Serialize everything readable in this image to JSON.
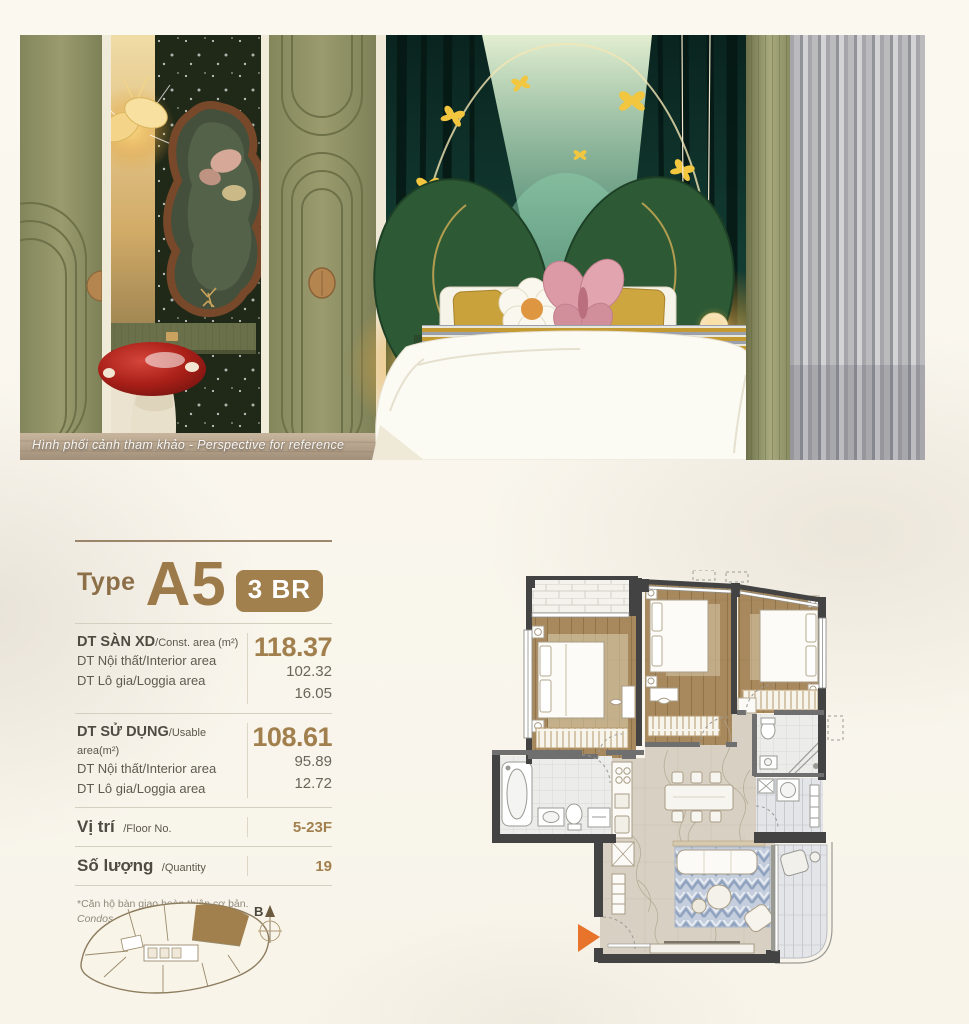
{
  "hero": {
    "caption": "Hình phối cảnh tham khảo - Perspective for reference"
  },
  "unit": {
    "type_label": "Type",
    "type_code": "A5",
    "badge": "3 BR"
  },
  "specs": {
    "sections": [
      {
        "label_vi": "DT SÀN XD",
        "label_en": "/Const. area (m²)",
        "value": "118.37",
        "rows": [
          {
            "label": "DT Nội thất/Interior area",
            "value": "102.32"
          },
          {
            "label": "DT Lô gia/Loggia area",
            "value": "16.05"
          }
        ]
      },
      {
        "label_vi": "DT SỬ DỤNG",
        "label_en": "/Usable area(m²)",
        "value": "108.61",
        "rows": [
          {
            "label": "DT Nội thất/Interior area",
            "value": "95.89"
          },
          {
            "label": "DT Lô gia/Loggia area",
            "value": "12.72"
          }
        ]
      }
    ],
    "floor": {
      "label_vi": "Vị trí",
      "label_en": "/Floor No.",
      "value": "5-23F"
    },
    "quantity": {
      "label_vi": "Số lượng",
      "label_en": "/Quantity",
      "value": "19"
    }
  },
  "footnote": {
    "line1": "*Căn hộ bàn giao hoàn thiện cơ bản.",
    "line2": "Condos are standard-style handover."
  },
  "keyplan": {
    "compass_label": "B"
  },
  "colors": {
    "accent": "#a1804e",
    "entry_arrow": "#e8742c"
  }
}
